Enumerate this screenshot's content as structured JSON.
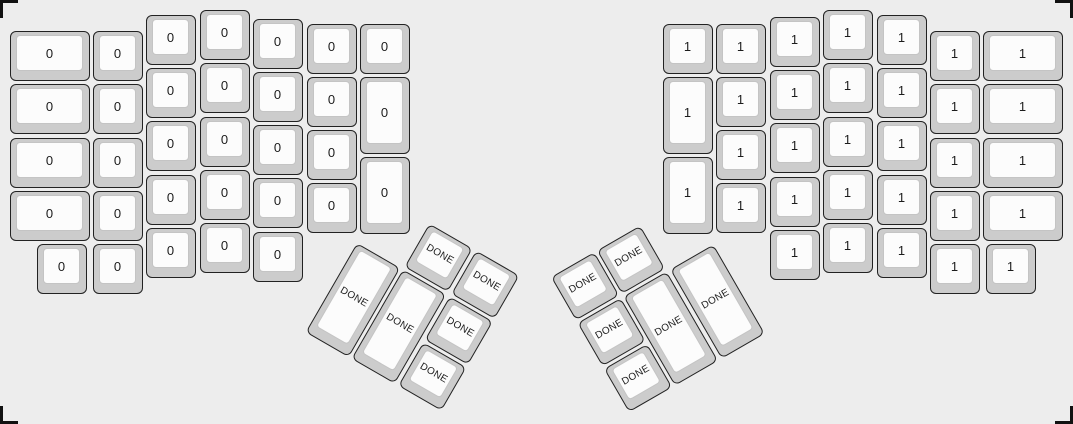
{
  "canvas": {
    "background": "#ededed",
    "key_side_color": "#cccccc",
    "key_top_color": "#fcfcfc",
    "key_border_color": "#222222",
    "label_color": "#1c1c1c",
    "width": 1073,
    "height": 424
  },
  "legends": {
    "left_half": "0",
    "right_half": "1",
    "thumb_clusters": "DONE"
  },
  "keyboard": {
    "groups": [
      {
        "name": "left-main",
        "label": "0",
        "rotation": 0,
        "origin": [
          0,
          0
        ],
        "keys": [
          [
            10,
            31,
            80,
            50
          ],
          [
            10,
            84,
            80,
            50
          ],
          [
            10,
            138,
            80,
            50
          ],
          [
            10,
            191,
            80,
            50
          ],
          [
            93,
            31,
            50,
            50
          ],
          [
            93,
            84,
            50,
            50
          ],
          [
            93,
            138,
            50,
            50
          ],
          [
            93,
            191,
            50,
            50
          ],
          [
            93,
            244,
            50,
            50
          ],
          [
            37,
            244,
            50,
            50
          ],
          [
            146,
            15,
            50,
            50
          ],
          [
            146,
            68,
            50,
            50
          ],
          [
            146,
            121,
            50,
            50
          ],
          [
            146,
            175,
            50,
            50
          ],
          [
            146,
            228,
            50,
            50
          ],
          [
            200,
            10,
            50,
            50
          ],
          [
            200,
            63,
            50,
            50
          ],
          [
            200,
            117,
            50,
            50
          ],
          [
            200,
            170,
            50,
            50
          ],
          [
            200,
            223,
            50,
            50
          ],
          [
            253,
            19,
            50,
            50
          ],
          [
            253,
            72,
            50,
            50
          ],
          [
            253,
            125,
            50,
            50
          ],
          [
            253,
            178,
            50,
            50
          ],
          [
            253,
            232,
            50,
            50
          ],
          [
            307,
            24,
            50,
            50
          ],
          [
            307,
            77,
            50,
            50
          ],
          [
            307,
            130,
            50,
            50
          ],
          [
            307,
            183,
            50,
            50
          ],
          [
            360,
            24,
            50,
            50
          ],
          [
            360,
            77,
            50,
            77
          ],
          [
            360,
            157,
            50,
            77
          ]
        ]
      },
      {
        "name": "right-main",
        "label": "1",
        "rotation": 0,
        "origin": [
          0,
          0
        ],
        "keys": [
          [
            663,
            24,
            50,
            50
          ],
          [
            663,
            77,
            50,
            77
          ],
          [
            663,
            157,
            50,
            77
          ],
          [
            716,
            24,
            50,
            50
          ],
          [
            716,
            77,
            50,
            50
          ],
          [
            716,
            130,
            50,
            50
          ],
          [
            716,
            183,
            50,
            50
          ],
          [
            770,
            17,
            50,
            50
          ],
          [
            770,
            70,
            50,
            50
          ],
          [
            770,
            123,
            50,
            50
          ],
          [
            770,
            177,
            50,
            50
          ],
          [
            770,
            230,
            50,
            50
          ],
          [
            823,
            10,
            50,
            50
          ],
          [
            823,
            63,
            50,
            50
          ],
          [
            823,
            117,
            50,
            50
          ],
          [
            823,
            170,
            50,
            50
          ],
          [
            823,
            223,
            50,
            50
          ],
          [
            877,
            15,
            50,
            50
          ],
          [
            877,
            68,
            50,
            50
          ],
          [
            877,
            121,
            50,
            50
          ],
          [
            877,
            175,
            50,
            50
          ],
          [
            877,
            228,
            50,
            50
          ],
          [
            930,
            31,
            50,
            50
          ],
          [
            930,
            84,
            50,
            50
          ],
          [
            930,
            138,
            50,
            50
          ],
          [
            930,
            191,
            50,
            50
          ],
          [
            930,
            244,
            50,
            50
          ],
          [
            983,
            31,
            80,
            50
          ],
          [
            983,
            84,
            80,
            50
          ],
          [
            983,
            138,
            80,
            50
          ],
          [
            983,
            191,
            80,
            50
          ],
          [
            986,
            244,
            50,
            50
          ]
        ]
      },
      {
        "name": "left-thumb",
        "label": "DONE",
        "rotation": 30,
        "origin": [
          357,
          243
        ],
        "keys": [
          [
            53,
            -53,
            50,
            50
          ],
          [
            107,
            -53,
            50,
            50
          ],
          [
            0,
            0,
            50,
            103
          ],
          [
            53,
            0,
            50,
            103
          ],
          [
            107,
            0,
            50,
            50
          ],
          [
            107,
            53,
            50,
            50
          ]
        ]
      },
      {
        "name": "right-thumb",
        "label": "DONE",
        "rotation": -30,
        "origin": [
          716,
          243
        ],
        "keys": [
          [
            -160,
            -53,
            50,
            50
          ],
          [
            -107,
            -53,
            50,
            50
          ],
          [
            -160,
            0,
            50,
            50
          ],
          [
            -107,
            0,
            50,
            103
          ],
          [
            -53,
            0,
            50,
            103
          ],
          [
            -160,
            53,
            50,
            50
          ]
        ]
      }
    ]
  }
}
